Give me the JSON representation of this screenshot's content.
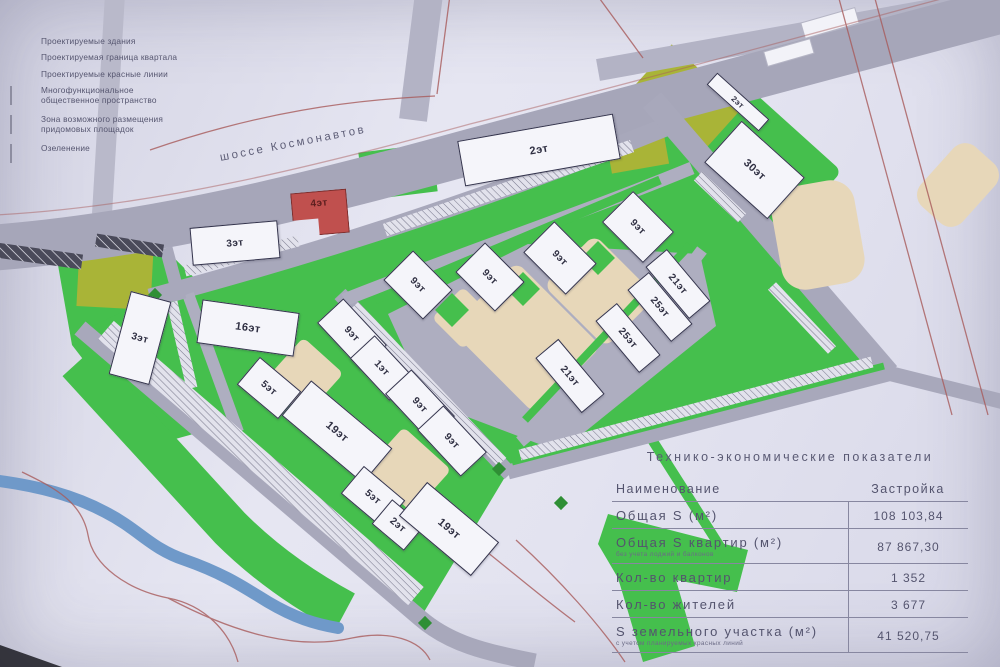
{
  "legend": {
    "items": [
      {
        "label": "Проектируемые здания"
      },
      {
        "label": "Проектируемая граница квартала"
      },
      {
        "label": "Проектируемые красные линии"
      },
      {
        "label": "Многофункциональное общественное пространство"
      },
      {
        "label": "Зона возможного размещения придомовых площадок"
      },
      {
        "label": "Озеленение"
      }
    ]
  },
  "map": {
    "street_label": "шоссе Космонавтов",
    "buildings": [
      {
        "label": "3эт"
      },
      {
        "label": "4эт"
      },
      {
        "label": "2эт"
      },
      {
        "label": "2эт"
      },
      {
        "label": "30эт"
      },
      {
        "label": "3эт"
      },
      {
        "label": "16эт"
      },
      {
        "label": "5эт"
      },
      {
        "label": "19эт"
      },
      {
        "label": "5эт"
      },
      {
        "label": "2эт"
      },
      {
        "label": "19эт"
      },
      {
        "label": "9эт"
      },
      {
        "label": "1эт"
      },
      {
        "label": "9эт"
      },
      {
        "label": "9эт"
      },
      {
        "label": "9эт"
      },
      {
        "label": "9эт"
      },
      {
        "label": "9эт"
      },
      {
        "label": "9эт"
      },
      {
        "label": "21эт"
      },
      {
        "label": "25эт"
      },
      {
        "label": "25эт"
      },
      {
        "label": "21эт"
      }
    ]
  },
  "table": {
    "title": "Технико-экономические показатели",
    "columns": [
      "Наименование",
      "Застройка"
    ],
    "rows": [
      {
        "name": "Общая S (м²)",
        "note": "",
        "value": "108 103,84"
      },
      {
        "name": "Общая S квартир (м²)",
        "note": "без учета лоджий и балконов",
        "value": "87 867,30"
      },
      {
        "name": "Кол-во квартир",
        "note": "",
        "value": "1 352"
      },
      {
        "name": "Кол-во жителей",
        "note": "",
        "value": "3 677"
      },
      {
        "name": "S земельного участка (м²)",
        "note": "с учетом планируемых красных линий",
        "value": "41 520,75"
      }
    ]
  },
  "colors": {
    "greenery": "#45bf4d",
    "public_space": "#a9b437",
    "yard_zone": "#e7d7b9",
    "road": "#a8a8bb",
    "building_fill": "#f5f5fa",
    "accent_building": "#c0504e",
    "water": "#6f99c9",
    "red_line": "#a85b5b"
  }
}
